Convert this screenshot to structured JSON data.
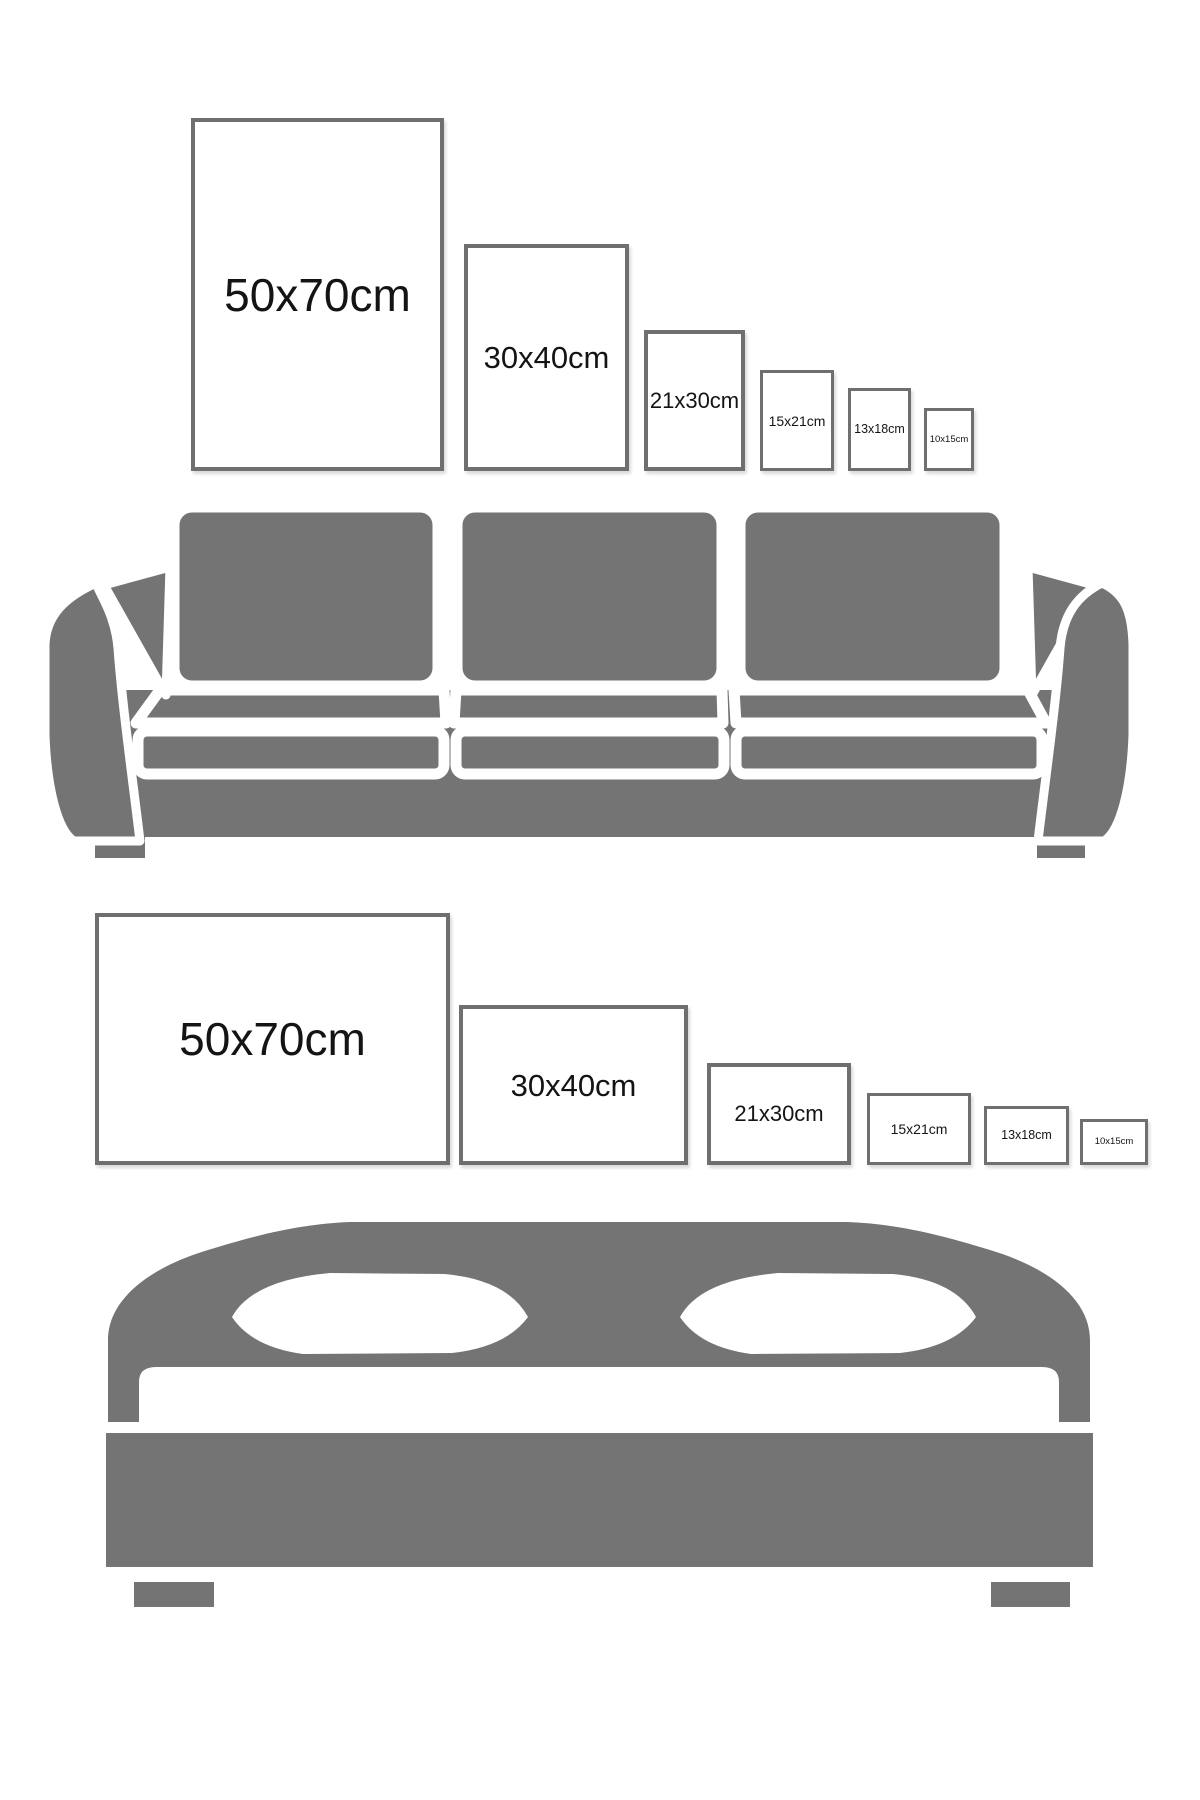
{
  "title": "Frame size comparison guide",
  "colors": {
    "background": "#ffffff",
    "furniture_gray": "#747474",
    "frame_border": "#6f6f6f",
    "label_text": "#141414"
  },
  "sections": [
    {
      "id": "portrait-wall",
      "furniture": "sofa",
      "furniture_icon": "sofa-icon",
      "orientation": "portrait",
      "frames": [
        {
          "label": "50x70cm",
          "width_cm": 50,
          "height_cm": 70
        },
        {
          "label": "30x40cm",
          "width_cm": 30,
          "height_cm": 40
        },
        {
          "label": "21x30cm",
          "width_cm": 21,
          "height_cm": 30
        },
        {
          "label": "15x21cm",
          "width_cm": 15,
          "height_cm": 21
        },
        {
          "label": "13x18cm",
          "width_cm": 13,
          "height_cm": 18
        },
        {
          "label": "10x15cm",
          "width_cm": 10,
          "height_cm": 15
        }
      ]
    },
    {
      "id": "landscape-wall",
      "furniture": "bed",
      "furniture_icon": "bed-icon",
      "orientation": "landscape",
      "frames": [
        {
          "label": "50x70cm",
          "width_cm": 70,
          "height_cm": 50
        },
        {
          "label": "30x40cm",
          "width_cm": 40,
          "height_cm": 30
        },
        {
          "label": "21x30cm",
          "width_cm": 30,
          "height_cm": 21
        },
        {
          "label": "15x21cm",
          "width_cm": 21,
          "height_cm": 15
        },
        {
          "label": "13x18cm",
          "width_cm": 18,
          "height_cm": 13
        },
        {
          "label": "10x15cm",
          "width_cm": 15,
          "height_cm": 10
        }
      ]
    }
  ]
}
